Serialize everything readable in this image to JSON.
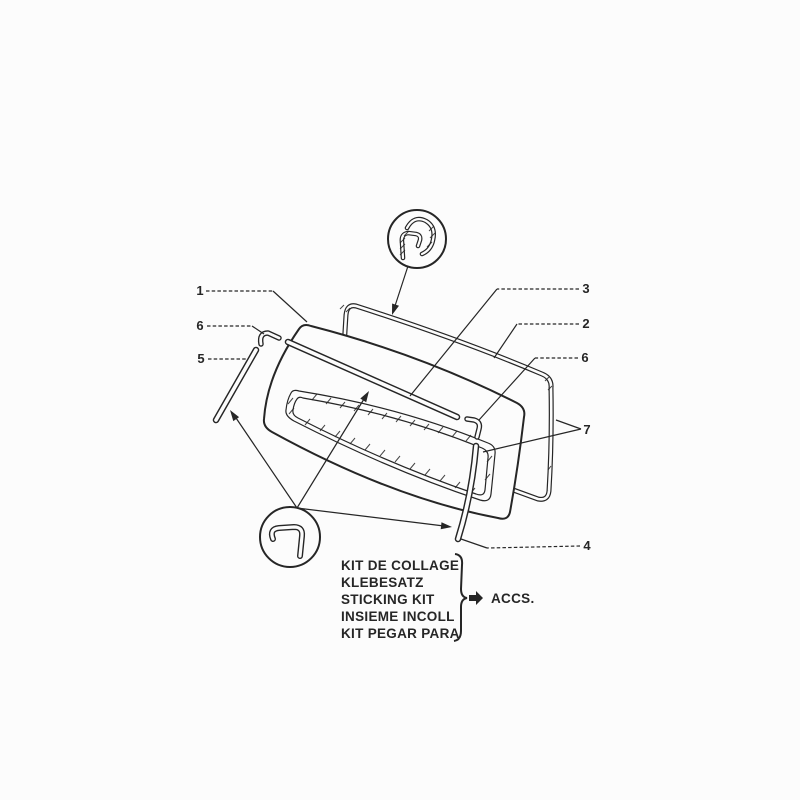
{
  "figure": {
    "kind": "parts-diagram",
    "subject": "windshield glass, molding and finisher strips"
  },
  "colors": {
    "ink": "#262626",
    "paper": "#fcfcfc"
  },
  "callouts": [
    {
      "num": "1"
    },
    {
      "num": "6"
    },
    {
      "num": "5"
    },
    {
      "num": "3"
    },
    {
      "num": "2"
    },
    {
      "num": "6"
    },
    {
      "num": "7"
    },
    {
      "num": "4"
    }
  ],
  "detail_views": {
    "top_circle_icon": "molding-cross-section-profile",
    "bottom_circle_icon": "finisher-strip-cross-section-profile"
  },
  "kit_box": {
    "lines": [
      "KIT DE COLLAGE",
      "KLEBESATZ",
      "STICKING KIT",
      "INSIEME INCOLL",
      "KIT PEGAR PARA"
    ],
    "arrow_label": "ACCS."
  }
}
